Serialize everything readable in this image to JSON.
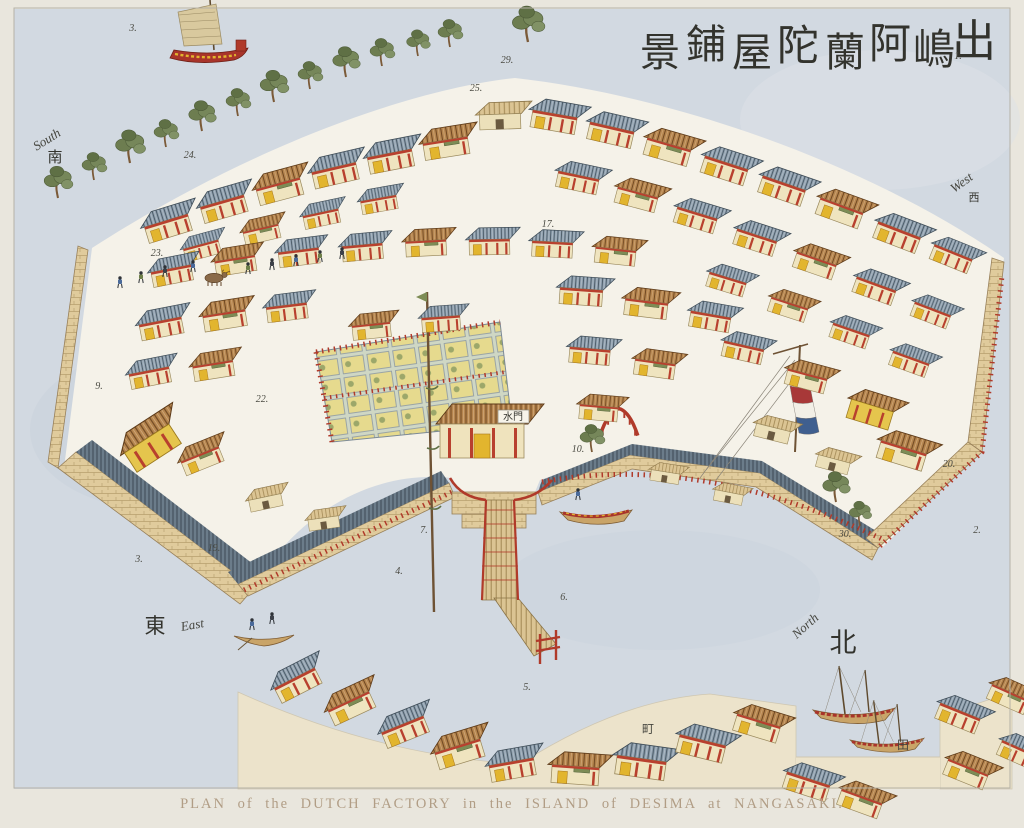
{
  "caption": "PLAN of the DUTCH FACTORY in the ISLAND of DESIMA at NANGASAKI.",
  "title_calligraphy": {
    "characters": [
      "景",
      "鋪",
      "屋",
      "陀",
      "蘭",
      "阿",
      "嶋",
      "出"
    ],
    "positions": [
      [
        660,
        66,
        40
      ],
      [
        706,
        58,
        40
      ],
      [
        752,
        66,
        40
      ],
      [
        798,
        60,
        42
      ],
      [
        845,
        66,
        40
      ],
      [
        890,
        58,
        42
      ],
      [
        934,
        64,
        42
      ],
      [
        974,
        56,
        44
      ]
    ]
  },
  "compass": [
    {
      "label": "South",
      "kanji": "南",
      "x": 49,
      "y": 143,
      "rot": -32,
      "kx": 55,
      "ky": 162,
      "ksize": 15
    },
    {
      "label": "West",
      "kanji": "西",
      "x": 964,
      "y": 186,
      "rot": -36,
      "kx": 974,
      "ky": 201,
      "ksize": 11
    },
    {
      "label": "East",
      "kanji": "東",
      "x": 193,
      "y": 629,
      "rot": -10,
      "kx": 155,
      "ky": 633,
      "ksize": 21
    },
    {
      "label": "North",
      "kanji": "北",
      "x": 808,
      "y": 629,
      "rot": -42,
      "kx": 843,
      "ky": 652,
      "ksize": 27
    }
  ],
  "plot_numbers": [
    {
      "n": "3.",
      "x": 133,
      "y": 31
    },
    {
      "n": "29.",
      "x": 507,
      "y": 63
    },
    {
      "n": "25.",
      "x": 476,
      "y": 91
    },
    {
      "n": "1.",
      "x": 958,
      "y": 59
    },
    {
      "n": "24.",
      "x": 190,
      "y": 158
    },
    {
      "n": "17.",
      "x": 548,
      "y": 227
    },
    {
      "n": "23.",
      "x": 157,
      "y": 256
    },
    {
      "n": "22.",
      "x": 262,
      "y": 402
    },
    {
      "n": "9.",
      "x": 99,
      "y": 389
    },
    {
      "n": "10.",
      "x": 578,
      "y": 452
    },
    {
      "n": "7.",
      "x": 424,
      "y": 533
    },
    {
      "n": "4.",
      "x": 399,
      "y": 574
    },
    {
      "n": "6.",
      "x": 564,
      "y": 600
    },
    {
      "n": "19.",
      "x": 214,
      "y": 551
    },
    {
      "n": "3.",
      "x": 139,
      "y": 562
    },
    {
      "n": "20.",
      "x": 949,
      "y": 467
    },
    {
      "n": "30.",
      "x": 845,
      "y": 537
    },
    {
      "n": "2.",
      "x": 977,
      "y": 533
    },
    {
      "n": "5.",
      "x": 527,
      "y": 690
    }
  ],
  "signs": [
    {
      "text": "水門",
      "x": 513,
      "y": 420
    }
  ],
  "kanji_marks": [
    {
      "t": "町",
      "x": 648,
      "y": 733
    },
    {
      "t": "田",
      "x": 903,
      "y": 749
    }
  ],
  "colors": {
    "water": "#d2d9e1",
    "island_ground": "#f5f2e9",
    "wall_brick": "#e0cb9c",
    "walkway": "#6b7c8a",
    "roof_blue": "#8fa0af",
    "roof_brown": "#b5854e",
    "timber_red": "#b03a2a",
    "accent_yellow": "#e2b52e",
    "foliage": "#76875a",
    "flag_red": "#a83838",
    "flag_white": "#f2efe6",
    "flag_blue": "#3f5f8f",
    "ink": "#3b3b34",
    "caption_ink": "#b19d85"
  }
}
